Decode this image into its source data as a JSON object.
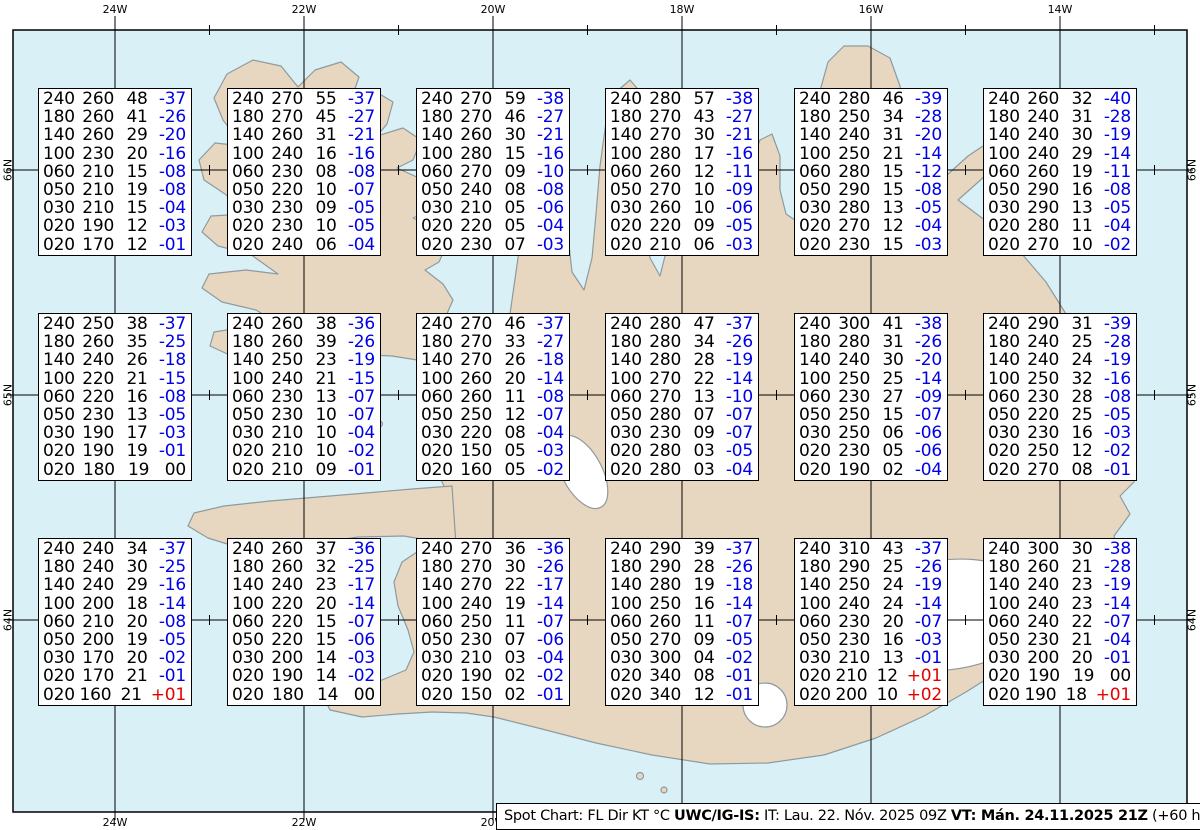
{
  "caption": {
    "segments": [
      {
        "text": "Spot Chart: FL Dir KT °C ",
        "bold": false
      },
      {
        "text": "UWC/IG-IS:",
        "bold": true
      },
      {
        "text": " IT: Lau. 22. Nóv. 2025 09Z ",
        "bold": false
      },
      {
        "text": "VT: Mán. 24.11.2025 21Z",
        "bold": true
      },
      {
        "text": " (+60 h)",
        "bold": false
      }
    ]
  },
  "grid": {
    "meridians": [
      {
        "label": "24W",
        "x": 115
      },
      {
        "label": "22W",
        "x": 304
      },
      {
        "label": "20W",
        "x": 493
      },
      {
        "label": "18W",
        "x": 682
      },
      {
        "label": "16W",
        "x": 871
      },
      {
        "label": "14W",
        "x": 1060
      }
    ],
    "parallels": [
      {
        "label": "66N",
        "y": 170
      },
      {
        "label": "65N",
        "y": 395
      },
      {
        "label": "64N",
        "y": 620
      }
    ]
  },
  "colors": {
    "ocean": "#d9f1f6",
    "land": "#e8d7c0",
    "coastline": "#8e9a9e",
    "negative_temp": "#0000e6",
    "positive_temp": "#e60000",
    "text": "#000000"
  },
  "chart_data": {
    "type": "table",
    "columns": [
      "FL",
      "Dir",
      "KT",
      "°C"
    ],
    "spots": [
      {
        "col": 0,
        "row": 0,
        "rows": [
          [
            "240",
            "260",
            "48",
            "-37"
          ],
          [
            "180",
            "260",
            "41",
            "-26"
          ],
          [
            "140",
            "260",
            "29",
            "-20"
          ],
          [
            "100",
            "230",
            "20",
            "-16"
          ],
          [
            "060",
            "210",
            "15",
            "-08"
          ],
          [
            "050",
            "210",
            "19",
            "-08"
          ],
          [
            "030",
            "210",
            "15",
            "-04"
          ],
          [
            "020",
            "190",
            "12",
            "-03"
          ],
          [
            "020",
            "170",
            "12",
            "-01"
          ]
        ]
      },
      {
        "col": 1,
        "row": 0,
        "rows": [
          [
            "240",
            "270",
            "55",
            "-37"
          ],
          [
            "180",
            "270",
            "45",
            "-27"
          ],
          [
            "140",
            "260",
            "31",
            "-21"
          ],
          [
            "100",
            "240",
            "16",
            "-16"
          ],
          [
            "060",
            "230",
            "08",
            "-08"
          ],
          [
            "050",
            "220",
            "10",
            "-07"
          ],
          [
            "030",
            "230",
            "09",
            "-05"
          ],
          [
            "020",
            "230",
            "10",
            "-05"
          ],
          [
            "020",
            "240",
            "06",
            "-04"
          ]
        ]
      },
      {
        "col": 2,
        "row": 0,
        "rows": [
          [
            "240",
            "270",
            "59",
            "-38"
          ],
          [
            "180",
            "270",
            "46",
            "-27"
          ],
          [
            "140",
            "260",
            "30",
            "-21"
          ],
          [
            "100",
            "280",
            "15",
            "-16"
          ],
          [
            "060",
            "270",
            "09",
            "-10"
          ],
          [
            "050",
            "240",
            "08",
            "-08"
          ],
          [
            "030",
            "210",
            "05",
            "-06"
          ],
          [
            "020",
            "220",
            "05",
            "-04"
          ],
          [
            "020",
            "230",
            "07",
            "-03"
          ]
        ]
      },
      {
        "col": 3,
        "row": 0,
        "rows": [
          [
            "240",
            "280",
            "57",
            "-38"
          ],
          [
            "180",
            "270",
            "43",
            "-27"
          ],
          [
            "140",
            "270",
            "30",
            "-21"
          ],
          [
            "100",
            "280",
            "17",
            "-16"
          ],
          [
            "060",
            "260",
            "12",
            "-11"
          ],
          [
            "050",
            "270",
            "10",
            "-09"
          ],
          [
            "030",
            "260",
            "10",
            "-06"
          ],
          [
            "020",
            "220",
            "09",
            "-05"
          ],
          [
            "020",
            "210",
            "06",
            "-03"
          ]
        ]
      },
      {
        "col": 4,
        "row": 0,
        "rows": [
          [
            "240",
            "280",
            "46",
            "-39"
          ],
          [
            "180",
            "250",
            "34",
            "-28"
          ],
          [
            "140",
            "240",
            "31",
            "-20"
          ],
          [
            "100",
            "250",
            "21",
            "-14"
          ],
          [
            "060",
            "280",
            "15",
            "-12"
          ],
          [
            "050",
            "290",
            "15",
            "-08"
          ],
          [
            "030",
            "280",
            "13",
            "-05"
          ],
          [
            "020",
            "270",
            "12",
            "-04"
          ],
          [
            "020",
            "230",
            "15",
            "-03"
          ]
        ]
      },
      {
        "col": 5,
        "row": 0,
        "rows": [
          [
            "240",
            "260",
            "32",
            "-40"
          ],
          [
            "180",
            "240",
            "31",
            "-28"
          ],
          [
            "140",
            "240",
            "30",
            "-19"
          ],
          [
            "100",
            "240",
            "29",
            "-14"
          ],
          [
            "060",
            "260",
            "19",
            "-11"
          ],
          [
            "050",
            "290",
            "16",
            "-08"
          ],
          [
            "030",
            "290",
            "13",
            "-05"
          ],
          [
            "020",
            "280",
            "11",
            "-04"
          ],
          [
            "020",
            "270",
            "10",
            "-02"
          ]
        ]
      },
      {
        "col": 0,
        "row": 1,
        "rows": [
          [
            "240",
            "250",
            "38",
            "-37"
          ],
          [
            "180",
            "260",
            "35",
            "-25"
          ],
          [
            "140",
            "240",
            "26",
            "-18"
          ],
          [
            "100",
            "220",
            "21",
            "-15"
          ],
          [
            "060",
            "220",
            "16",
            "-08"
          ],
          [
            "050",
            "230",
            "13",
            "-05"
          ],
          [
            "030",
            "190",
            "17",
            "-03"
          ],
          [
            "020",
            "190",
            "19",
            "-01"
          ],
          [
            "020",
            "180",
            "19",
            "00"
          ]
        ]
      },
      {
        "col": 1,
        "row": 1,
        "rows": [
          [
            "240",
            "260",
            "38",
            "-36"
          ],
          [
            "180",
            "260",
            "39",
            "-26"
          ],
          [
            "140",
            "250",
            "23",
            "-19"
          ],
          [
            "100",
            "240",
            "21",
            "-15"
          ],
          [
            "060",
            "230",
            "13",
            "-07"
          ],
          [
            "050",
            "230",
            "10",
            "-07"
          ],
          [
            "030",
            "210",
            "10",
            "-04"
          ],
          [
            "020",
            "210",
            "10",
            "-02"
          ],
          [
            "020",
            "210",
            "09",
            "-01"
          ]
        ]
      },
      {
        "col": 2,
        "row": 1,
        "rows": [
          [
            "240",
            "270",
            "46",
            "-37"
          ],
          [
            "180",
            "270",
            "33",
            "-27"
          ],
          [
            "140",
            "270",
            "26",
            "-18"
          ],
          [
            "100",
            "260",
            "20",
            "-14"
          ],
          [
            "060",
            "260",
            "11",
            "-08"
          ],
          [
            "050",
            "250",
            "12",
            "-07"
          ],
          [
            "030",
            "220",
            "08",
            "-04"
          ],
          [
            "020",
            "150",
            "05",
            "-03"
          ],
          [
            "020",
            "160",
            "05",
            "-02"
          ]
        ]
      },
      {
        "col": 3,
        "row": 1,
        "rows": [
          [
            "240",
            "280",
            "47",
            "-37"
          ],
          [
            "180",
            "280",
            "34",
            "-26"
          ],
          [
            "140",
            "280",
            "28",
            "-19"
          ],
          [
            "100",
            "270",
            "22",
            "-14"
          ],
          [
            "060",
            "270",
            "13",
            "-10"
          ],
          [
            "050",
            "280",
            "07",
            "-07"
          ],
          [
            "030",
            "230",
            "09",
            "-07"
          ],
          [
            "020",
            "280",
            "03",
            "-05"
          ],
          [
            "020",
            "280",
            "03",
            "-04"
          ]
        ]
      },
      {
        "col": 4,
        "row": 1,
        "rows": [
          [
            "240",
            "300",
            "41",
            "-38"
          ],
          [
            "180",
            "280",
            "31",
            "-26"
          ],
          [
            "140",
            "240",
            "30",
            "-20"
          ],
          [
            "100",
            "250",
            "25",
            "-14"
          ],
          [
            "060",
            "230",
            "27",
            "-09"
          ],
          [
            "050",
            "250",
            "15",
            "-07"
          ],
          [
            "030",
            "250",
            "06",
            "-06"
          ],
          [
            "020",
            "230",
            "05",
            "-06"
          ],
          [
            "020",
            "190",
            "02",
            "-04"
          ]
        ]
      },
      {
        "col": 5,
        "row": 1,
        "rows": [
          [
            "240",
            "290",
            "31",
            "-39"
          ],
          [
            "180",
            "240",
            "25",
            "-28"
          ],
          [
            "140",
            "240",
            "24",
            "-19"
          ],
          [
            "100",
            "250",
            "32",
            "-16"
          ],
          [
            "060",
            "230",
            "28",
            "-08"
          ],
          [
            "050",
            "220",
            "25",
            "-05"
          ],
          [
            "030",
            "230",
            "16",
            "-03"
          ],
          [
            "020",
            "250",
            "12",
            "-02"
          ],
          [
            "020",
            "270",
            "08",
            "-01"
          ]
        ]
      },
      {
        "col": 0,
        "row": 2,
        "rows": [
          [
            "240",
            "240",
            "34",
            "-37"
          ],
          [
            "180",
            "240",
            "30",
            "-25"
          ],
          [
            "140",
            "240",
            "29",
            "-16"
          ],
          [
            "100",
            "200",
            "18",
            "-14"
          ],
          [
            "060",
            "210",
            "20",
            "-08"
          ],
          [
            "050",
            "200",
            "19",
            "-05"
          ],
          [
            "030",
            "170",
            "20",
            "-02"
          ],
          [
            "020",
            "170",
            "21",
            "-01"
          ],
          [
            "020",
            "160",
            "21",
            "+01"
          ]
        ]
      },
      {
        "col": 1,
        "row": 2,
        "rows": [
          [
            "240",
            "260",
            "37",
            "-36"
          ],
          [
            "180",
            "260",
            "32",
            "-25"
          ],
          [
            "140",
            "240",
            "23",
            "-17"
          ],
          [
            "100",
            "220",
            "20",
            "-14"
          ],
          [
            "060",
            "220",
            "15",
            "-07"
          ],
          [
            "050",
            "220",
            "15",
            "-06"
          ],
          [
            "030",
            "200",
            "14",
            "-03"
          ],
          [
            "020",
            "190",
            "14",
            "-02"
          ],
          [
            "020",
            "180",
            "14",
            "00"
          ]
        ]
      },
      {
        "col": 2,
        "row": 2,
        "rows": [
          [
            "240",
            "270",
            "36",
            "-36"
          ],
          [
            "180",
            "270",
            "30",
            "-26"
          ],
          [
            "140",
            "270",
            "22",
            "-17"
          ],
          [
            "100",
            "240",
            "19",
            "-14"
          ],
          [
            "060",
            "250",
            "11",
            "-07"
          ],
          [
            "050",
            "230",
            "07",
            "-06"
          ],
          [
            "030",
            "210",
            "03",
            "-04"
          ],
          [
            "020",
            "190",
            "02",
            "-02"
          ],
          [
            "020",
            "150",
            "02",
            "-01"
          ]
        ]
      },
      {
        "col": 3,
        "row": 2,
        "rows": [
          [
            "240",
            "290",
            "39",
            "-37"
          ],
          [
            "180",
            "290",
            "28",
            "-26"
          ],
          [
            "140",
            "280",
            "19",
            "-18"
          ],
          [
            "100",
            "250",
            "16",
            "-14"
          ],
          [
            "060",
            "260",
            "11",
            "-07"
          ],
          [
            "050",
            "270",
            "09",
            "-05"
          ],
          [
            "030",
            "300",
            "04",
            "-02"
          ],
          [
            "020",
            "340",
            "08",
            "-01"
          ],
          [
            "020",
            "340",
            "12",
            "-01"
          ]
        ]
      },
      {
        "col": 4,
        "row": 2,
        "rows": [
          [
            "240",
            "310",
            "43",
            "-37"
          ],
          [
            "180",
            "290",
            "25",
            "-26"
          ],
          [
            "140",
            "250",
            "24",
            "-19"
          ],
          [
            "100",
            "240",
            "24",
            "-14"
          ],
          [
            "060",
            "230",
            "20",
            "-07"
          ],
          [
            "050",
            "230",
            "16",
            "-03"
          ],
          [
            "030",
            "210",
            "13",
            "-01"
          ],
          [
            "020",
            "210",
            "12",
            "+01"
          ],
          [
            "020",
            "200",
            "10",
            "+02"
          ]
        ]
      },
      {
        "col": 5,
        "row": 2,
        "rows": [
          [
            "240",
            "300",
            "30",
            "-38"
          ],
          [
            "180",
            "260",
            "21",
            "-28"
          ],
          [
            "140",
            "240",
            "23",
            "-19"
          ],
          [
            "100",
            "240",
            "23",
            "-14"
          ],
          [
            "060",
            "240",
            "22",
            "-07"
          ],
          [
            "050",
            "230",
            "21",
            "-04"
          ],
          [
            "030",
            "200",
            "20",
            "-01"
          ],
          [
            "020",
            "190",
            "19",
            "00"
          ],
          [
            "020",
            "190",
            "18",
            "+01"
          ]
        ]
      }
    ]
  }
}
